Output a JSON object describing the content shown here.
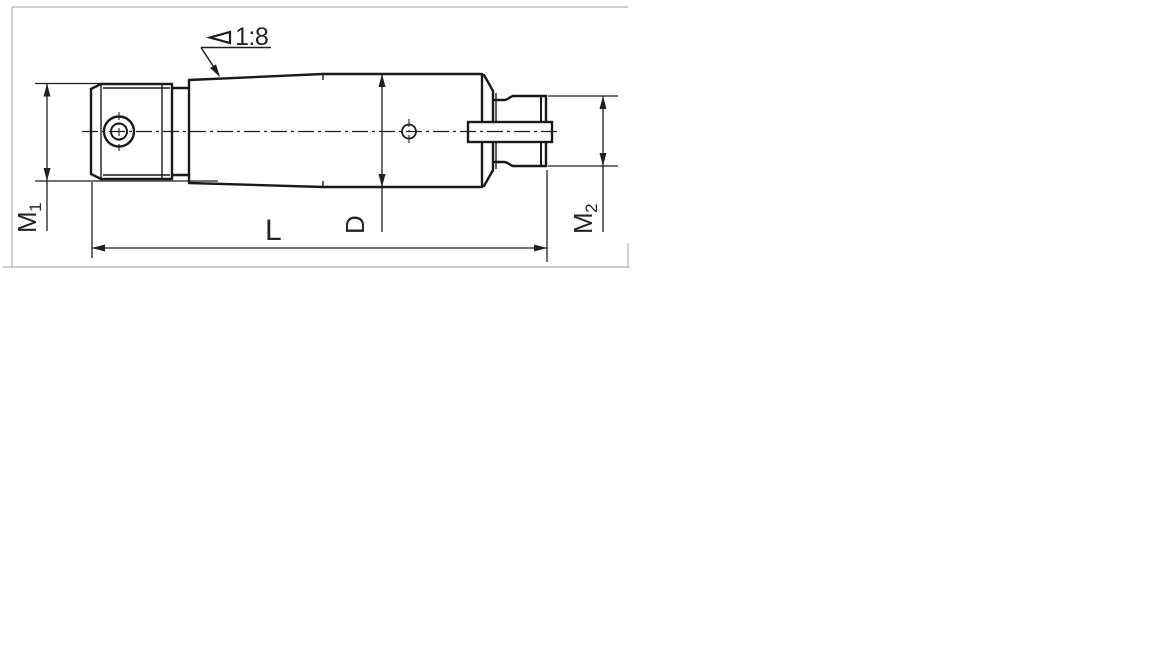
{
  "drawing": {
    "taper_note": "1:8",
    "dimension_labels": {
      "m1": {
        "base": "M",
        "sub": "1"
      },
      "m2": {
        "base": "M",
        "sub": "2"
      },
      "length": "L",
      "diameter": "D"
    },
    "colors": {
      "line": "#1a1a1a",
      "label": "#23232e",
      "frame": "#b5b5b5",
      "background": "#ffffff"
    }
  }
}
